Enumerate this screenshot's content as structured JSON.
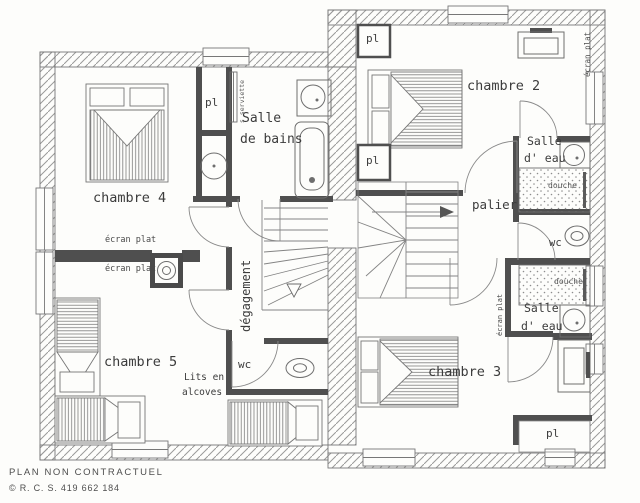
{
  "document": {
    "kind": "architectural floor plan (scanned, first floor of a house)",
    "footer": {
      "disclaimer": "PLAN NON CONTRACTUEL",
      "registration": "© R. C. S. 419 662 184"
    }
  },
  "rooms": {
    "chambre2": "chambre 2",
    "chambre3": "chambre 3",
    "chambre4": "chambre 4",
    "chambre5": "chambre 5",
    "palier": "palier",
    "degagement": "dégagement",
    "wc": "wc",
    "salle_de_bains": {
      "line1": "Salle",
      "line2": "de bains"
    },
    "salle_eau": {
      "line1": "Salle",
      "line2": "d' eau"
    }
  },
  "annotations": {
    "placard": "pl",
    "douche": "douche",
    "ecran_plat": "écran plat",
    "seche_serviettes": "s serviette",
    "lits_en_alcoves": {
      "line1": "Lits en",
      "line2": "alcoves"
    }
  },
  "colors": {
    "paper": "#fdfdfb",
    "line": "#6e6e6e",
    "hatch": "#9a9a9a",
    "wall_dark": "#4f4f4f",
    "text": "#3c3c3c"
  }
}
